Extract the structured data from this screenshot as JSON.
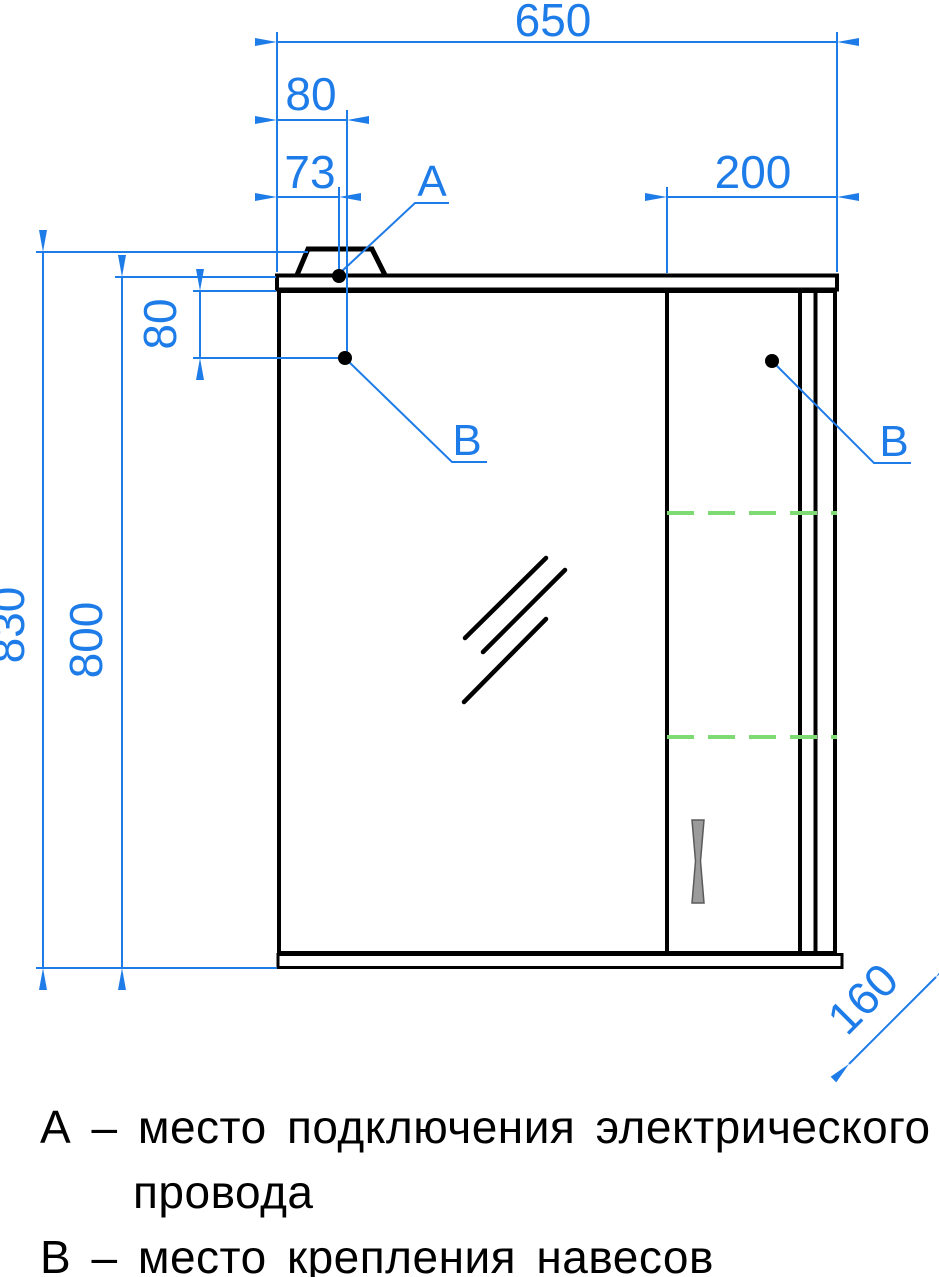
{
  "colors": {
    "dimension_blue": "#1e7ce8",
    "drawing_black": "#000000",
    "shelf_green": "#7edb74",
    "handle_gray": "#9b9b9b",
    "background": "#ffffff"
  },
  "dimensions": {
    "width_total": "650",
    "lamp_mount_offset": "80",
    "wire_point_offset": "73",
    "right_section_width": "200",
    "hinge_point_drop": "80",
    "height_total": "830",
    "body_height": "800",
    "depth": "160"
  },
  "labels": {
    "point_a": "А",
    "point_b_left": "В",
    "point_b_right": "В"
  },
  "legend": {
    "line1": "А – место подключения электрического",
    "line2": "провода",
    "line3": "В – место крепления навесов"
  }
}
